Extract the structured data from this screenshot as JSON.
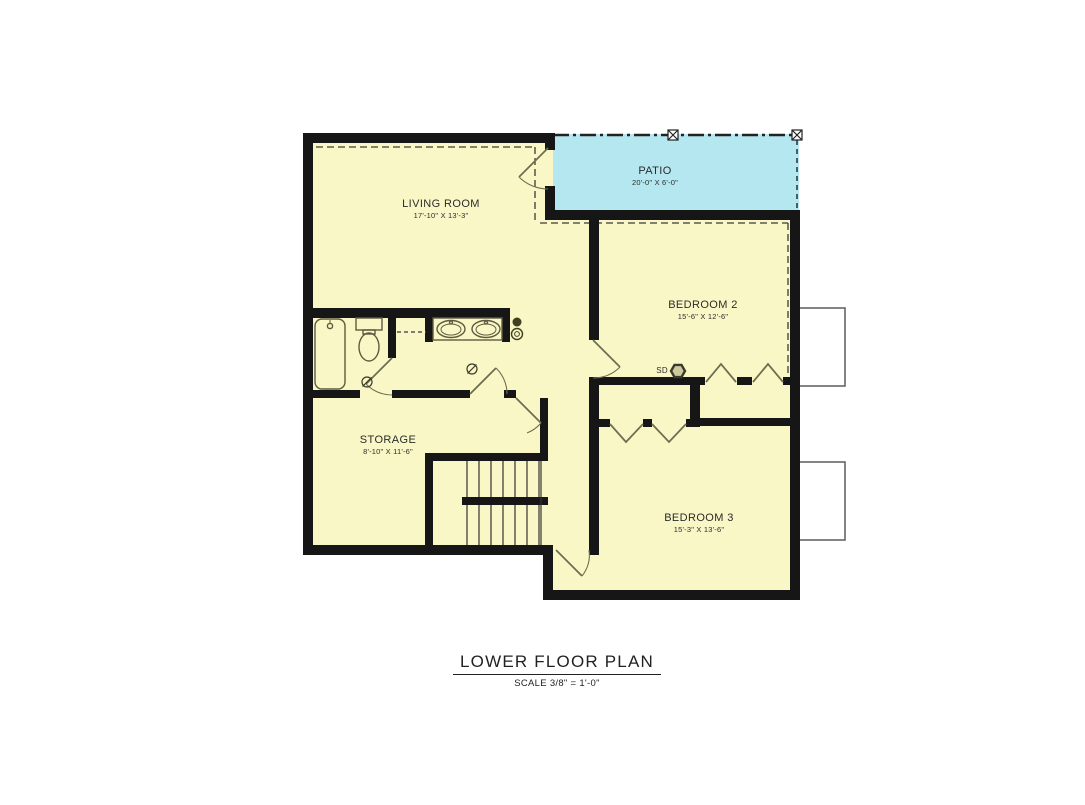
{
  "drawing": {
    "title": "LOWER FLOOR PLAN",
    "scale_note": "SCALE 3/8\" = 1'-0\"",
    "rooms": [
      {
        "name": "LIVING ROOM",
        "dims": "17'-10\" X 13'-3\""
      },
      {
        "name": "PATIO",
        "dims": "20'-0\" X 6'-0\""
      },
      {
        "name": "BEDROOM 2",
        "dims": "15'-6\" X 12'-6\""
      },
      {
        "name": "STORAGE",
        "dims": "8'-10\" X 11'-6\""
      },
      {
        "name": "BEDROOM 3",
        "dims": "15'-3\" X 13'-6\""
      }
    ],
    "labels": {
      "smoke_detector": "SD"
    },
    "colors": {
      "floor_fill": "#faf7c6",
      "patio_fill": "#b5e7f0",
      "wall": "#161616",
      "fixture_line": "#6e6e50",
      "dashed_line": "#3a3a3a",
      "window_well_border": "#666666"
    },
    "fixtures": [
      "bathtub",
      "toilet",
      "double-sink-vanity",
      "smoke-detector",
      "ceiling-light",
      "hinged-door",
      "bifold-closet-door",
      "switchback-stairs",
      "window-well",
      "patio-post",
      "pocket-opening"
    ]
  }
}
